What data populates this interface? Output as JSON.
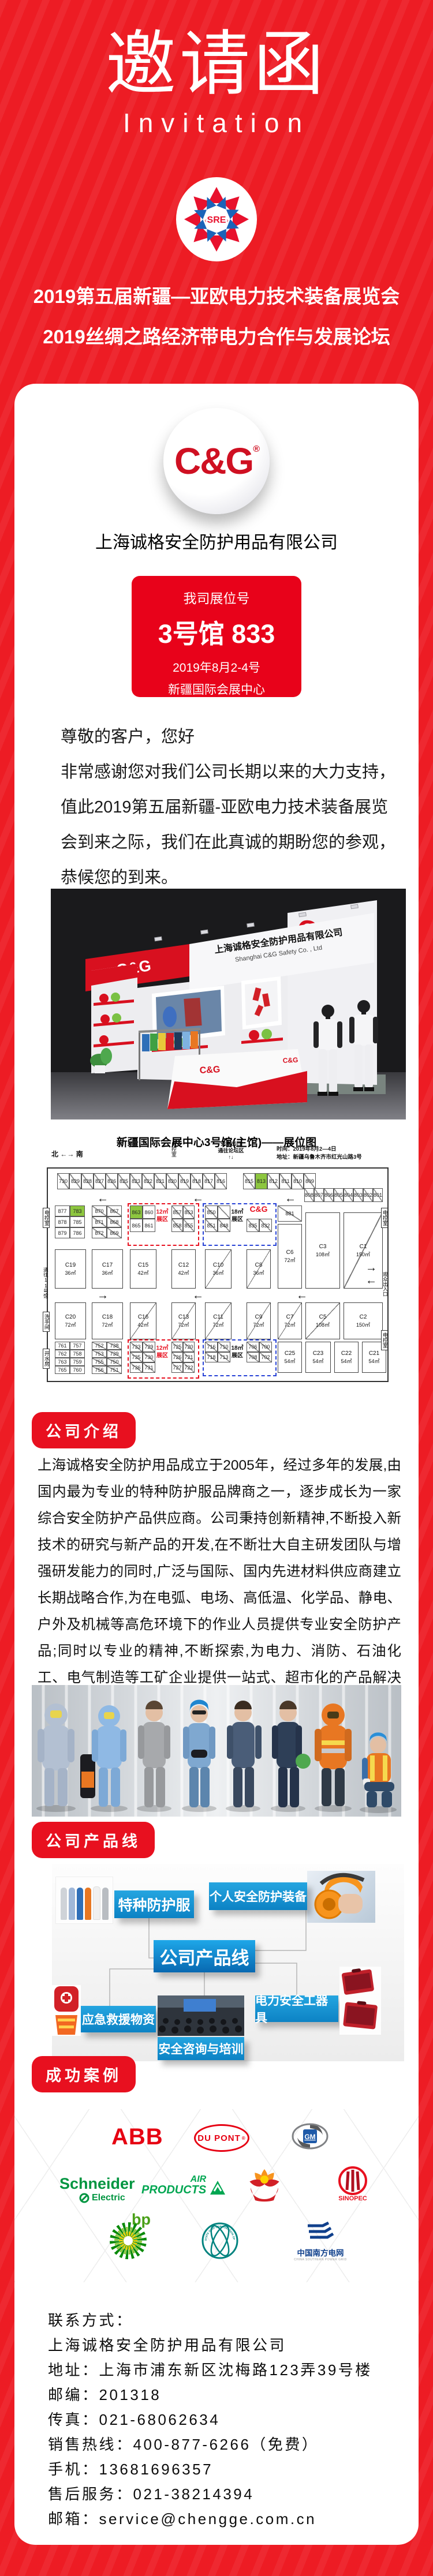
{
  "page": {
    "bg": "#ed1c24",
    "accent": "#e8101f",
    "blue": "#1795d4"
  },
  "header": {
    "brand_cn": "邀请函",
    "brand_en": "Invitation",
    "sre": "SRE",
    "title1": "2019第五届新疆—亚欧电力技术装备展览会",
    "title2": "2019丝绸之路经济带电力合作与发展论坛"
  },
  "company": {
    "logo": "C&G",
    "reg": "®",
    "name": "上海诚格安全防护用品有限公司"
  },
  "booth_box": {
    "label": "我司展位号",
    "hall": "3号馆 833",
    "date": "2019年8月2-4号",
    "venue": "新疆国际会展中心"
  },
  "greeting": {
    "salute": "尊敬的客户，您好",
    "body": "非常感谢您对我们公司长期以来的大力支持，值此2019第五届新疆-亚欧电力技术装备展览会到来之际，我们在此真诚的期盼您的参观，恭候您的到来。"
  },
  "booth_render": {
    "fascia_cn": "上海诚格安全防护用品有限公司",
    "fascia_en": "Shanghai C&G Safety Co. , Ltd",
    "logo": "C&G",
    "booth_no": "展位号：833"
  },
  "floor_plan": {
    "title": "新疆国际会展中心3号馆(主馆)——展位图",
    "north": "北",
    "south": "南",
    "compass_arrow": "←→",
    "exit_top1": "安全出口",
    "exit_top2": "通往论坛区",
    "time": "时间：2019年8月2—4日",
    "addr": "地址：新疆乌鲁木齐市红光山路3号",
    "ctl": "电控室",
    "to11": "通往11号馆",
    "wc": "洗手间",
    "water": "开水房",
    "audience": "观众出入口",
    "zone12": "12㎡",
    "zone18": "18㎡",
    "zone_word": "展区",
    "cg": "C&G",
    "b881": "881",
    "row_a": [
      "730",
      "829",
      "828",
      "827",
      "826",
      "825",
      "823",
      "822",
      "821",
      "820",
      "819",
      "818",
      "817",
      "816"
    ],
    "row_b": [
      "815",
      "813",
      "812",
      "811",
      "810",
      "809"
    ],
    "row_c": [
      "808",
      "807",
      "806",
      "805",
      "804",
      "803",
      "802",
      "801"
    ],
    "g1": [
      "877",
      "783",
      "878",
      "785",
      "879",
      "786"
    ],
    "g2": [
      "870",
      "867",
      "871",
      "868",
      "872",
      "869"
    ],
    "rz_top_a": [
      "863",
      "860",
      "865",
      "861"
    ],
    "rz_top_b": [
      "857",
      "853",
      "858",
      "855"
    ],
    "bz_top_a": [
      "850",
      "",
      "851",
      "848"
    ],
    "bz_top_b": [
      "835",
      "832"
    ],
    "g3": [
      "761",
      "757",
      "762",
      "758",
      "763",
      "759",
      "765",
      "760"
    ],
    "g4": [
      "752",
      "738",
      "753",
      "739",
      "755",
      "750",
      "756",
      "751"
    ],
    "rz_bot_a": [
      "733",
      "729",
      "735",
      "730",
      "736",
      "731"
    ],
    "rz_bot_b": [
      "725",
      "720",
      "726",
      "721",
      "727",
      "722"
    ],
    "bz_bot_a": [
      "716",
      "710",
      "718",
      "713"
    ],
    "bz_bot_b": [
      "706",
      "700",
      "708",
      "702"
    ],
    "halls": {
      "c19": {
        "n": "C19",
        "a": "36㎡"
      },
      "c17": {
        "n": "C17",
        "a": "36㎡"
      },
      "c15": {
        "n": "C15",
        "a": "42㎡"
      },
      "c12": {
        "n": "C12",
        "a": "42㎡"
      },
      "c10": {
        "n": "C10",
        "a": "36㎡"
      },
      "c8": {
        "n": "C8",
        "a": "36㎡"
      },
      "c6": {
        "n": "C6",
        "a": "72㎡"
      },
      "c3": {
        "n": "C3",
        "a": "108㎡"
      },
      "c1": {
        "n": "C1",
        "a": "150㎡"
      },
      "c20": {
        "n": "C20",
        "a": "72㎡"
      },
      "c18": {
        "n": "C18",
        "a": "72㎡"
      },
      "c16": {
        "n": "C16",
        "a": "42㎡"
      },
      "c13": {
        "n": "C13",
        "a": "72㎡"
      },
      "c11": {
        "n": "C11",
        "a": "72㎡"
      },
      "c9": {
        "n": "C9",
        "a": "72㎡"
      },
      "c7": {
        "n": "C7",
        "a": "72㎡"
      },
      "c5": {
        "n": "C5",
        "a": "108㎡"
      },
      "c2": {
        "n": "C2",
        "a": "150㎡"
      },
      "c25": {
        "n": "C25",
        "a": "54㎡"
      },
      "c23": {
        "n": "C23",
        "a": "54㎡"
      },
      "c22": {
        "n": "C22",
        "a": "54㎡"
      },
      "c21": {
        "n": "C21",
        "a": "54㎡"
      }
    }
  },
  "sections": {
    "intro": "公司介绍",
    "product": "公司产品线",
    "cases": "成功案例"
  },
  "intro": {
    "text": "上海诚格安全防护用品成立于2005年，经过多年的发展,由国内最为专业的特种防护服品牌商之一，逐步成长为一家综合安全防护产品供应商。公司秉持创新精神,不断投入新技术的研究与新产品的开发,在不断壮大自主研发团队与增强研发能力的同时,广泛与国际、国内先进材料供应商建立长期战略合作,为在电弧、电场、高低温、化学品、静电、户外及机械等高危环境下的作业人员提供专业安全防护产品;同时以专业的精神,不断探索,为电力、消防、石油化工、电气制造等工矿企业提供一站式、超市化的产品解决方案与安全咨询服务。"
  },
  "diagram": {
    "center": "公司产品线",
    "n1": "特种防护服",
    "n2": "个人安全防护装备",
    "n3": "应急救援物资",
    "n4": "安全咨询与培训",
    "n5": "电力安全工器具"
  },
  "clients": {
    "abb": "ABB",
    "dupont": "DU PONT",
    "reg": "®",
    "gm": "GM",
    "schneider": "Schneider",
    "electric": "Electric",
    "air1": "AIR",
    "air2": "PRODUCTS",
    "bp": "bp",
    "sinopec": "SINOPEC",
    "stategrid": "STATE GRID CORPORATION OF CHINA",
    "csg_cn": "中国南方电网",
    "csg_en": "CHINA SOUTHERN POWER GRID"
  },
  "contact": {
    "lines": [
      "联系方式：",
      "上海诚格安全防护用品有限公司",
      "地址：上海市浦东新区沈梅路123弄39号楼",
      "邮编：201318",
      "传真：021-68062634",
      "销售热线：400-877-6266（免费）",
      "手机：13681696357",
      "售后服务：021-38214394",
      "邮箱：service@chengge.com.cn"
    ]
  }
}
